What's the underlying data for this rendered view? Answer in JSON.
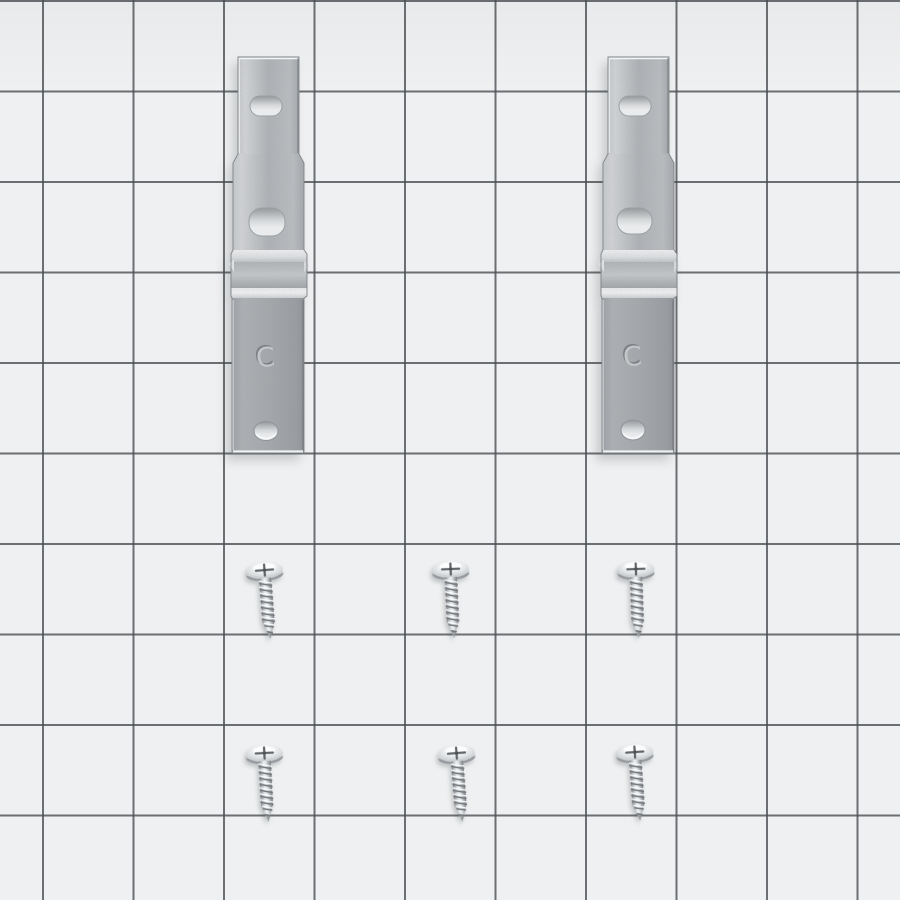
{
  "scene": {
    "type": "product-photo",
    "subject": "Hardware kit: two galvanized steel mounting brackets and six zinc self-tapping screws laid out on gray grid paper",
    "paper_color": "#eff0f1",
    "grid_line_color": "#4a4e52",
    "grid_cell_size_px": 91,
    "metal_color": "#aab0b4",
    "screw_color": "#dfe2e4"
  },
  "parts": {
    "bracket_count": 2,
    "screw_count": 6,
    "brackets": [
      {
        "id": "bracket-left",
        "stamp": "C",
        "finish": "galvanized",
        "hole_count": 3
      },
      {
        "id": "bracket-right",
        "stamp": "C",
        "finish": "galvanized",
        "hole_count": 3
      }
    ],
    "screws": [
      {
        "id": "screw-row1-left",
        "type": "phillips-pan-head"
      },
      {
        "id": "screw-row1-center",
        "type": "phillips-pan-head"
      },
      {
        "id": "screw-row1-right",
        "type": "phillips-pan-head"
      },
      {
        "id": "screw-row2-left",
        "type": "phillips-pan-head"
      },
      {
        "id": "screw-row2-center",
        "type": "phillips-pan-head"
      },
      {
        "id": "screw-row2-right",
        "type": "phillips-pan-head"
      }
    ]
  }
}
